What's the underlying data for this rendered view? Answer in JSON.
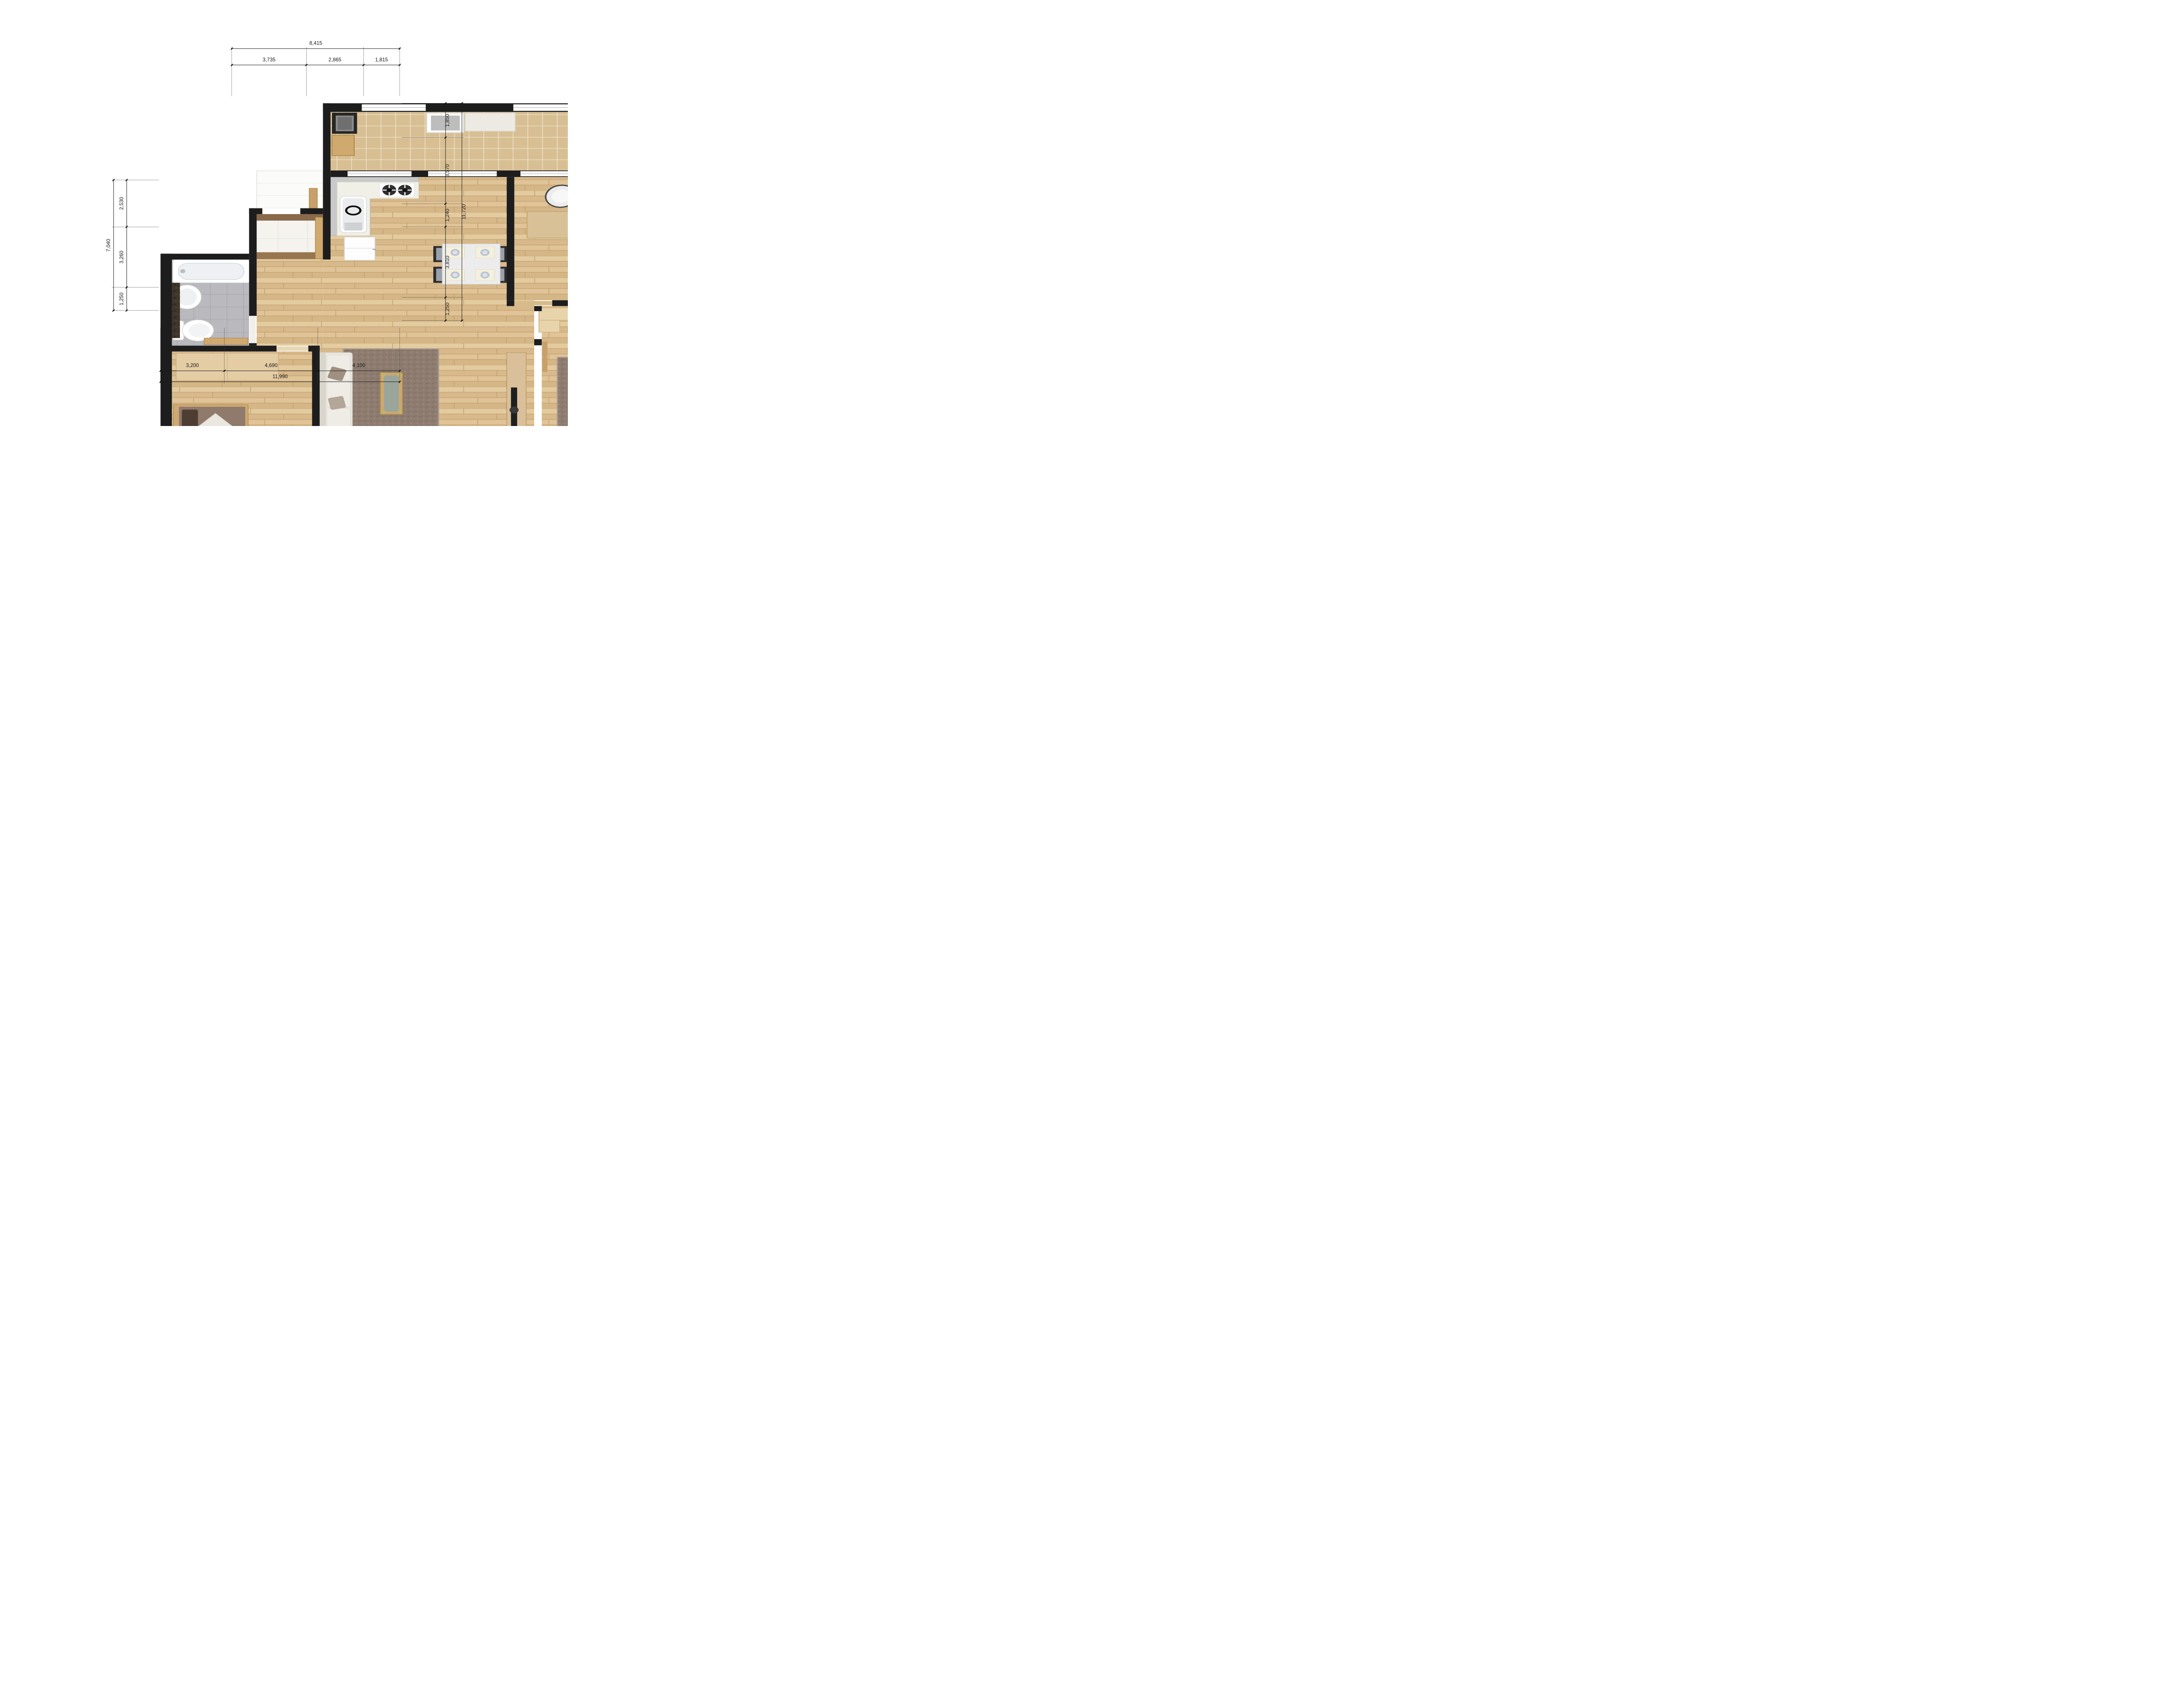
{
  "document": {
    "type": "apartment-floor-plan",
    "units_note": "millimetre dimension chains"
  },
  "dimensions": {
    "top": {
      "total": "8,415",
      "seg1": "3,735",
      "seg2": "2,865",
      "seg3": "1,815"
    },
    "bottom": {
      "total": "11,990",
      "seg1": "3,200",
      "seg2": "4,690",
      "seg3": "4,100"
    },
    "left": {
      "total": "7,040",
      "seg1": "2,530",
      "seg2": "3,260",
      "seg3": "1,250"
    },
    "right": {
      "total": "11,720",
      "seg1": "1,850",
      "seg2": "3,570",
      "seg3": "1,240",
      "seg4": "3,810",
      "seg5": "1,250"
    }
  },
  "colors": {
    "wall": "#1d1d1d",
    "wood_floor": "#ddc197",
    "balcony_tile": "#d8bf93",
    "bath_gray_tile": "#b9b9be",
    "bath_brown_tile": "#8b7a6b",
    "entry_tile": "#f4f3ee",
    "marble_threshold": "#8a6a4c",
    "rug": "#8e7c70",
    "counter_gray": "#c9c9c9",
    "cabinet_wood": "#cfa96f",
    "fixture_white": "#fdfdfd",
    "glass_teal": "#bfe0d6"
  },
  "fixtures": [
    "gas-hob",
    "kitchen-sink",
    "refrigerator",
    "dining-table",
    "washer",
    "ac-unit",
    "desk",
    "office-chair",
    "wardrobe",
    "shower-set",
    "glass-partition",
    "washbasin",
    "toilet",
    "bathtub",
    "pedestal-sink",
    "shoe-cabinet",
    "single-bed",
    "double-bed",
    "sofa",
    "coffee-table",
    "tv-console",
    "floor-cushion",
    "nightstand",
    "floor-drain",
    "granite-cabinet",
    "balcony-cabinet"
  ]
}
